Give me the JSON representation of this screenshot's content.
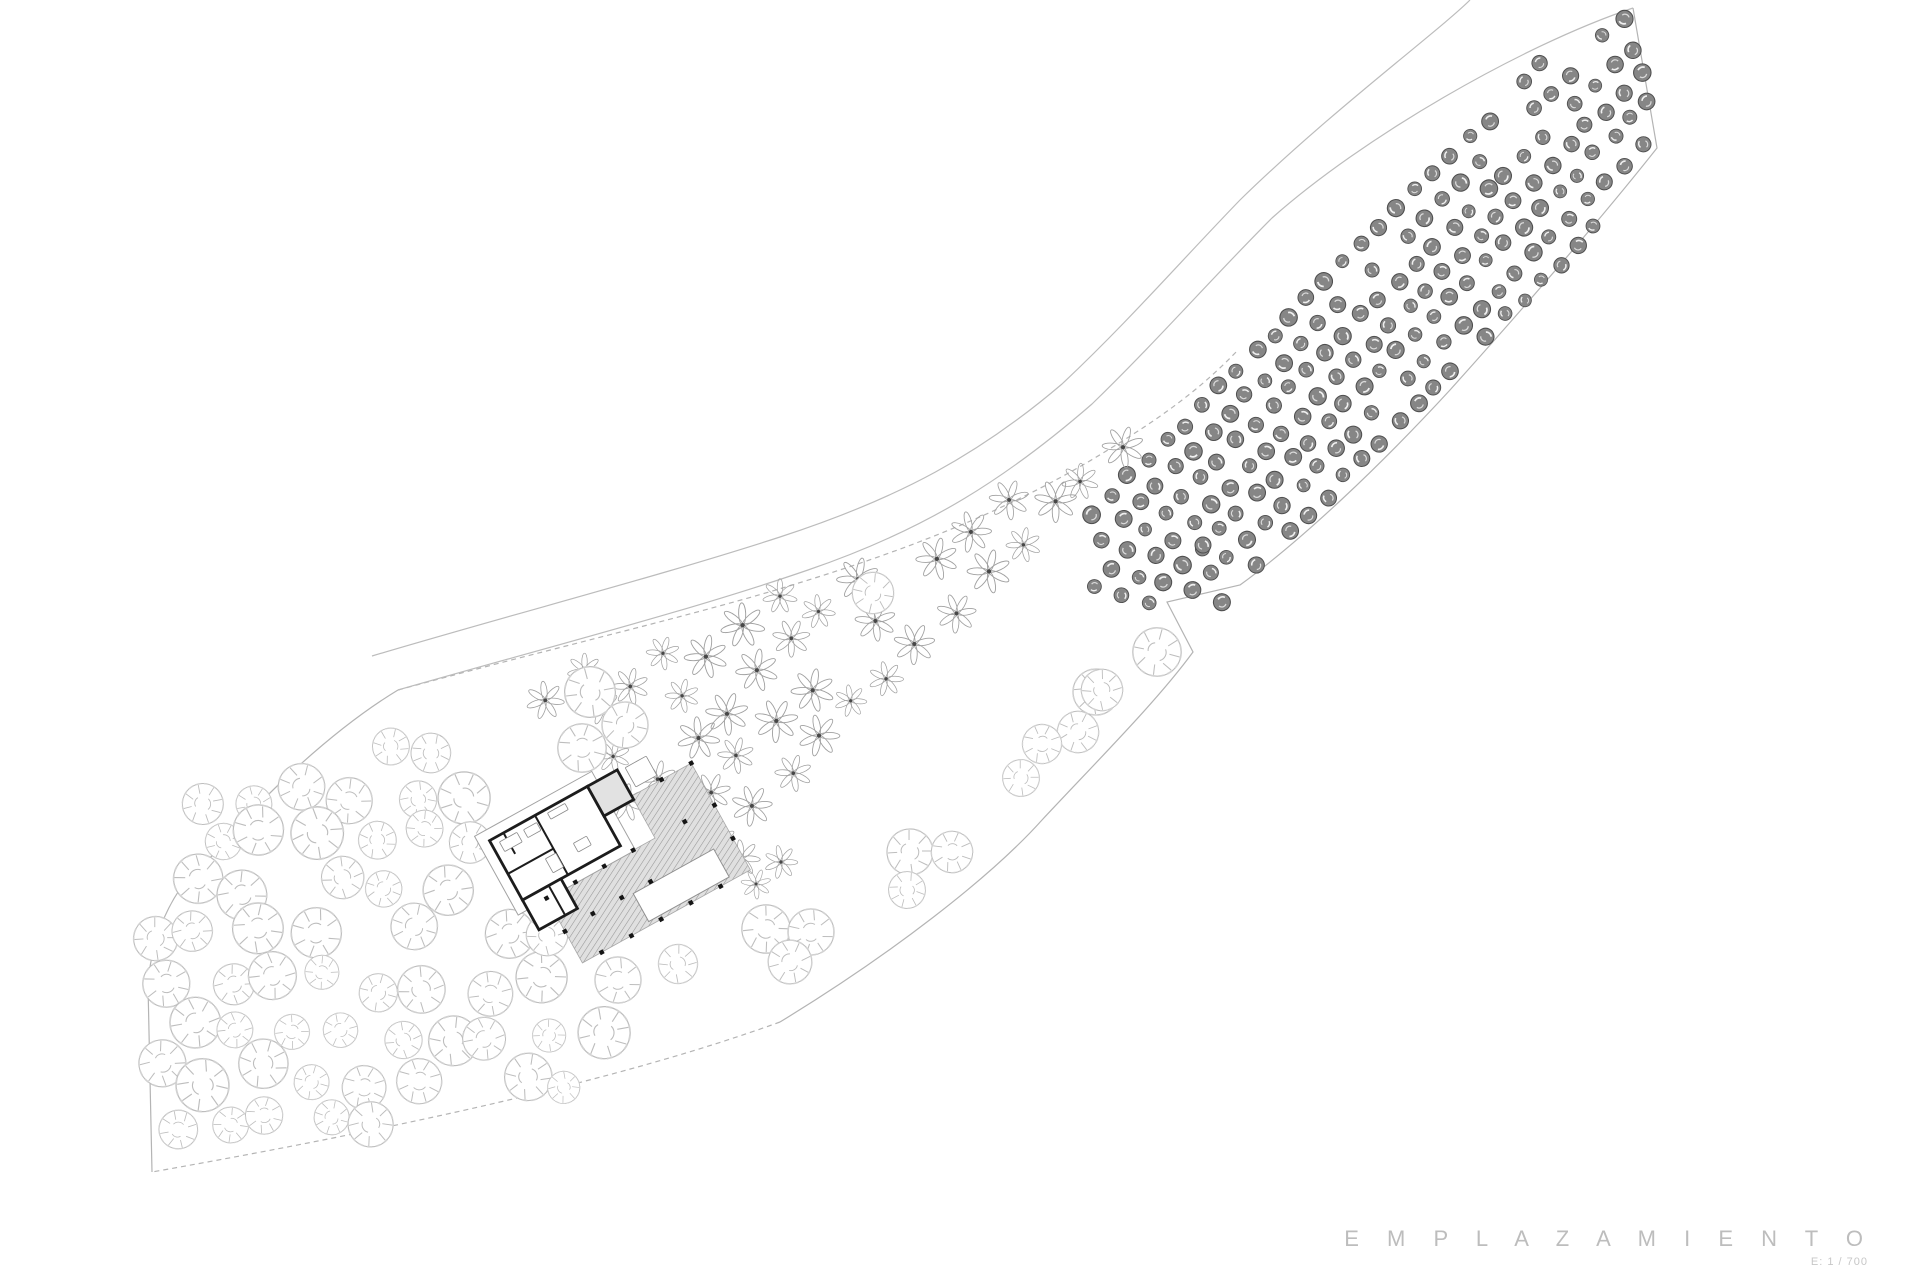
{
  "canvas": {
    "width": 1920,
    "height": 1280,
    "background": "#ffffff"
  },
  "title_block": {
    "title": "E M P L A Z A M I E N T O",
    "scale_label": "E: 1 / 700"
  },
  "colors": {
    "boundary_line": "#b4b4b4",
    "road_line": "#bcbcbc",
    "dark_tree_fill": "#868686",
    "dark_tree_stroke": "#4f4f4f",
    "star_tree_stroke": "#a0a0a0",
    "star_tree_center": "#474747",
    "round_tree_stroke": "#bdbdbd",
    "wall_stroke": "#1c1c1c",
    "roof_stroke": "#a2a2a2",
    "deck_fill_lines": "#969696",
    "deck_fill_bg": "#e0e0e0",
    "title_color": "#bdbdbd"
  },
  "site": {
    "paths": [
      {
        "name": "site-boundary-right",
        "d": "M 1633 8 L 1657 148 C 1600 220 1520 312 1450 390 C 1380 466 1302 540 1240 585 L 1167 602 L 1193 652 C 1158 700 1100 758 1042 820 C 990 878 890 955 780 1022",
        "dashed": false
      },
      {
        "name": "site-boundary-bottom",
        "d": "M 780 1022 C 620 1080 400 1128 152 1172",
        "dashed": true
      },
      {
        "name": "site-boundary-left",
        "d": "M 152 1172 L 148 985 C 152 928 178 880 212 856 C 258 800 332 730 398 690",
        "dashed": false
      },
      {
        "name": "site-inner-edge",
        "d": "M 398 690 C 560 646 700 614 802 582 C 912 548 1002 512 1088 462 C 1150 425 1195 395 1238 350",
        "dashed": true
      },
      {
        "name": "road-lower-edge",
        "d": "M 398 690 C 552 646 692 610 808 570 C 928 529 1008 477 1092 404 C 1158 340 1212 278 1272 218 C 1362 138 1520 46 1633 8",
        "dashed": false
      },
      {
        "name": "road-upper-edge",
        "d": "M 372 656 C 520 612 660 576 780 537 C 900 498 980 454 1062 384 C 1128 322 1180 262 1240 200 C 1330 112 1440 30 1470 0",
        "dashed": false
      }
    ]
  },
  "vegetation": {
    "clips": {
      "olive": [
        [
          1062,
          582
        ],
        [
          1100,
          472
        ],
        [
          1150,
          382
        ],
        [
          1230,
          270
        ],
        [
          1320,
          206
        ],
        [
          1430,
          140
        ],
        [
          1520,
          70
        ],
        [
          1600,
          22
        ],
        [
          1640,
          4
        ],
        [
          1657,
          150
        ],
        [
          1560,
          270
        ],
        [
          1450,
          390
        ],
        [
          1340,
          500
        ],
        [
          1262,
          565
        ],
        [
          1205,
          618
        ],
        [
          1125,
          600
        ]
      ],
      "almond": [
        [
          536,
          668
        ],
        [
          700,
          618
        ],
        [
          800,
          585
        ],
        [
          910,
          550
        ],
        [
          1000,
          500
        ],
        [
          1080,
          455
        ],
        [
          1160,
          415
        ],
        [
          1215,
          385
        ],
        [
          1235,
          405
        ],
        [
          1150,
          480
        ],
        [
          1140,
          645
        ],
        [
          1050,
          680
        ],
        [
          960,
          745
        ],
        [
          850,
          805
        ],
        [
          800,
          842
        ],
        [
          760,
          897
        ],
        [
          700,
          872
        ],
        [
          612,
          795
        ],
        [
          548,
          770
        ]
      ],
      "pine": [
        [
          152,
          860
        ],
        [
          220,
          782
        ],
        [
          330,
          742
        ],
        [
          430,
          700
        ],
        [
          475,
          715
        ],
        [
          490,
          790
        ],
        [
          475,
          865
        ],
        [
          525,
          950
        ],
        [
          610,
          1015
        ],
        [
          655,
          1065
        ],
        [
          560,
          1092
        ],
        [
          400,
          1122
        ],
        [
          220,
          1158
        ],
        [
          150,
          1168
        ]
      ]
    },
    "grids": [
      {
        "name": "olive-grove-dark-trees",
        "symbol": "sym-dark",
        "clip": "olive",
        "origin": [
          1068,
          575
        ],
        "u": [
          17.9,
          -17.9
        ],
        "v": [
          17.9,
          17.9
        ],
        "colStart": 0,
        "cols": 33,
        "rowStart": -1,
        "rows": 9,
        "stagger": 0.45,
        "jitter": 3,
        "skip": 0.05,
        "smin": 0.8,
        "smax": 1.1
      },
      {
        "name": "orchard-star-trees",
        "symbol": "sym-star",
        "clip": "almond",
        "origin": [
          536,
          652
        ],
        "u": [
          33,
          -33
        ],
        "v": [
          31,
          31
        ],
        "colStart": -1,
        "cols": 23,
        "rowStart": 0,
        "rows": 7,
        "stagger": 0.5,
        "jitter": 7,
        "skip": 0.05,
        "smin": 0.72,
        "smax": 1.05
      },
      {
        "name": "scattered-round-trees",
        "symbol": "sym-circle",
        "clip": "pine",
        "origin": [
          168,
          700
        ],
        "u": [
          52,
          0
        ],
        "v": [
          -8,
          47
        ],
        "colStart": 0,
        "cols": 10,
        "rowStart": 0,
        "rows": 11,
        "stagger": 0.4,
        "jitter": 13,
        "skip": 0.12,
        "smin": 0.7,
        "smax": 1.15
      }
    ],
    "singles": [
      {
        "symbol": "sym-circle",
        "x": 1096,
        "y": 692,
        "s": 1.0
      },
      {
        "symbol": "sym-circle",
        "x": 1078,
        "y": 732,
        "s": 0.9
      },
      {
        "symbol": "sym-circle",
        "x": 1042,
        "y": 744,
        "s": 0.85
      },
      {
        "symbol": "sym-circle",
        "x": 1021,
        "y": 778,
        "s": 0.8
      },
      {
        "symbol": "sym-circle",
        "x": 910,
        "y": 852,
        "s": 1.0
      },
      {
        "symbol": "sym-circle",
        "x": 952,
        "y": 852,
        "s": 0.9
      },
      {
        "symbol": "sym-circle",
        "x": 907,
        "y": 890,
        "s": 0.8
      },
      {
        "symbol": "sym-circle",
        "x": 766,
        "y": 929,
        "s": 1.05
      },
      {
        "symbol": "sym-circle",
        "x": 811,
        "y": 932,
        "s": 1.0
      },
      {
        "symbol": "sym-circle",
        "x": 790,
        "y": 962,
        "s": 0.95
      },
      {
        "symbol": "sym-circle",
        "x": 873,
        "y": 593,
        "s": 0.9
      },
      {
        "symbol": "sym-circle",
        "x": 1157,
        "y": 652,
        "s": 1.05
      },
      {
        "symbol": "sym-circle",
        "x": 1102,
        "y": 690,
        "s": 0.9
      },
      {
        "symbol": "sym-circle",
        "x": 618,
        "y": 980,
        "s": 1.0
      },
      {
        "symbol": "sym-circle",
        "x": 678,
        "y": 964,
        "s": 0.85
      },
      {
        "symbol": "sym-circle",
        "x": 547,
        "y": 935,
        "s": 0.9
      },
      {
        "symbol": "sym-circle",
        "x": 590,
        "y": 692,
        "s": 1.1
      },
      {
        "symbol": "sym-circle",
        "x": 625,
        "y": 725,
        "s": 1.0
      },
      {
        "symbol": "sym-circle",
        "x": 582,
        "y": 748,
        "s": 1.05
      },
      {
        "symbol": "sym-star",
        "x": 742,
        "y": 858,
        "s": 0.85
      },
      {
        "symbol": "sym-star",
        "x": 781,
        "y": 862,
        "s": 0.78
      },
      {
        "symbol": "sym-star",
        "x": 756,
        "y": 884,
        "s": 0.7
      },
      {
        "symbol": "sym-dark",
        "x": 1203,
        "y": 545,
        "s": 1.0
      }
    ]
  },
  "building": {
    "x": 601,
    "y": 852,
    "rotation": -29,
    "roof": {
      "x": -103,
      "y": -75,
      "w": 134,
      "h": 90
    },
    "deck": {
      "points": [
        [
          -70,
          14
        ],
        [
          54,
          14
        ],
        [
          54,
          -34
        ],
        [
          122,
          -34
        ],
        [
          122,
          88
        ],
        [
          -70,
          88
        ]
      ]
    },
    "pool": {
      "x": 8,
      "y": 52,
      "w": 92,
      "h": 32
    },
    "wall_rects": [
      {
        "x": -92,
        "y": -64,
        "w": 112,
        "h": 68,
        "fill": "#ffffff"
      },
      {
        "x": 20,
        "y": -64,
        "w": 34,
        "h": 34,
        "fill": "#e2e2e2"
      },
      {
        "x": -92,
        "y": 4,
        "w": 44,
        "h": 34,
        "fill": "#ffffff"
      }
    ],
    "wall_lines": [
      [
        -40,
        -64,
        -40,
        4
      ],
      [
        -92,
        -26,
        -40,
        -26
      ],
      [
        -62,
        4,
        -62,
        38
      ],
      [
        -76,
        -64,
        -76,
        -40
      ]
    ],
    "furniture": [
      {
        "x": -84,
        "y": -58,
        "w": 20,
        "h": 11
      },
      {
        "x": -57,
        "y": -57,
        "w": 15,
        "h": 9
      },
      {
        "x": -28,
        "y": -60,
        "w": 20,
        "h": 7
      },
      {
        "x": -20,
        "y": -21,
        "w": 15,
        "h": 10
      },
      {
        "x": -52,
        "y": -21,
        "w": 12,
        "h": 16
      },
      {
        "x": 62,
        "y": -62,
        "w": 24,
        "h": 22
      }
    ],
    "columns": [
      [
        -70,
        14
      ],
      [
        -37,
        14
      ],
      [
        -4,
        14
      ],
      [
        29,
        14
      ],
      [
        88,
        14
      ],
      [
        122,
        14
      ],
      [
        88,
        -34
      ],
      [
        122,
        -34
      ],
      [
        122,
        52
      ],
      [
        88,
        88
      ],
      [
        54,
        88
      ],
      [
        20,
        88
      ],
      [
        -14,
        88
      ],
      [
        -48,
        88
      ],
      [
        -70,
        52
      ],
      [
        -4,
        50
      ],
      [
        29,
        50
      ],
      [
        -37,
        50
      ]
    ]
  }
}
